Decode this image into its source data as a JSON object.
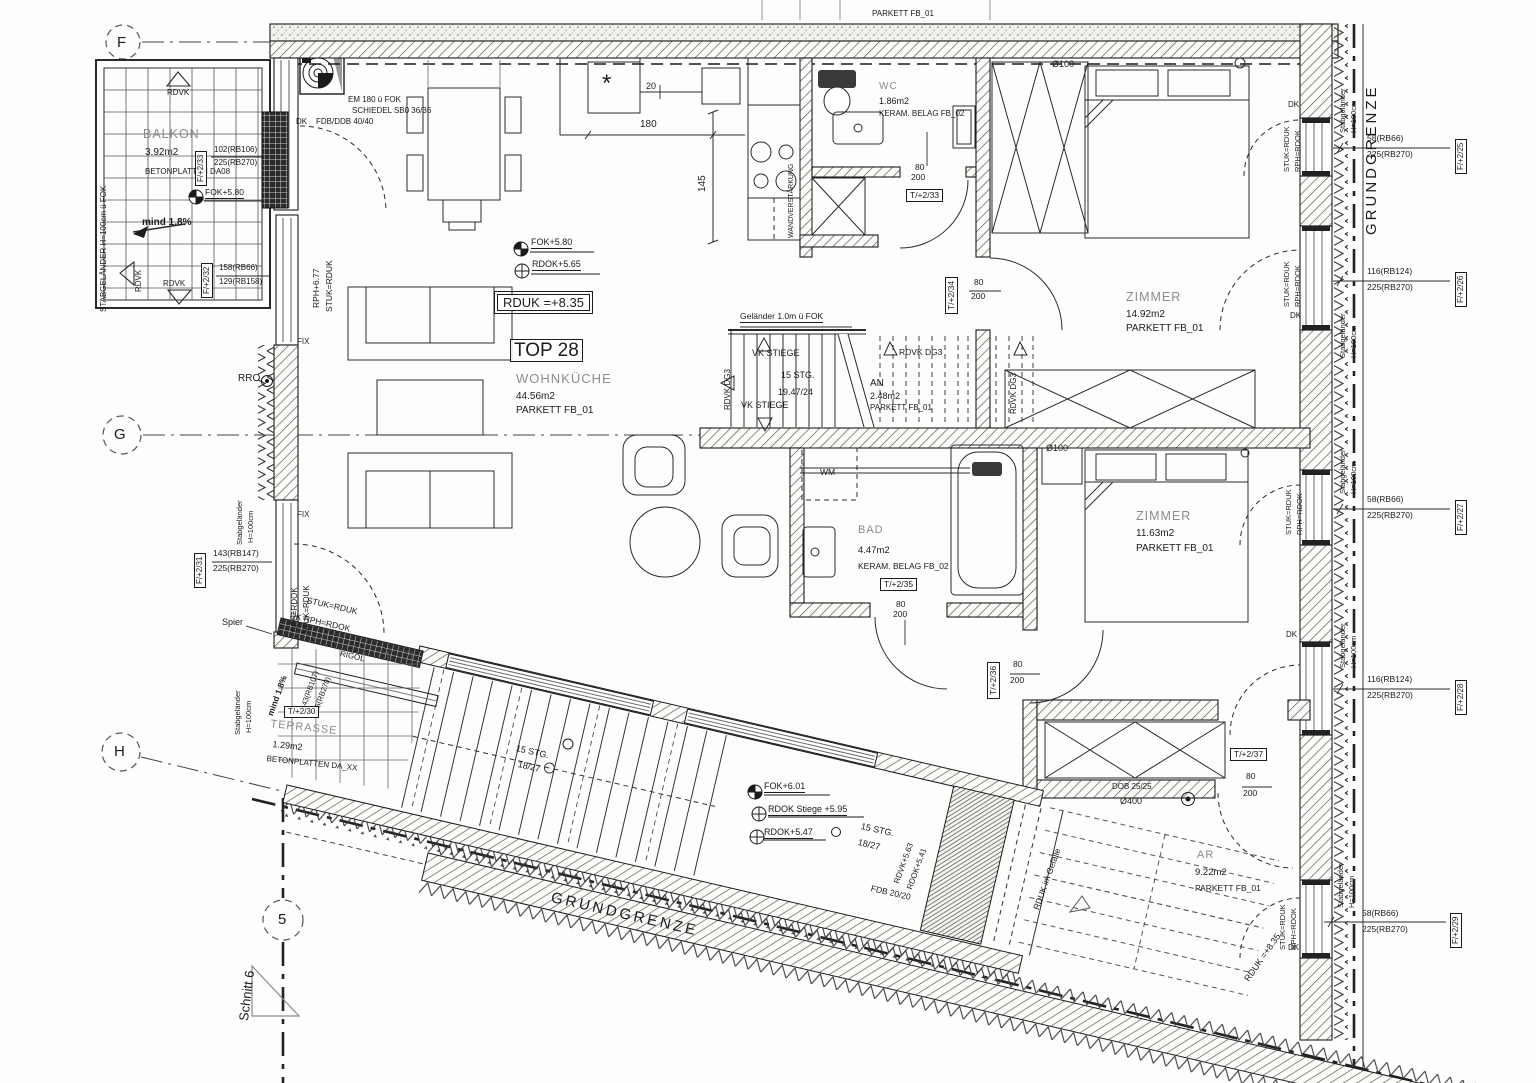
{
  "unit": {
    "tag": "TOP 28",
    "level_box": "RDUK =+8.35"
  },
  "rooms": {
    "wohnkueche": {
      "name": "WOHNKÜCHE",
      "area": "44.56m2",
      "floor": "PARKETT FB_01"
    },
    "balkon": {
      "name": "BALKON",
      "area": "3.92m2",
      "finish": "BETONPLATTEN DA08"
    },
    "terrasse": {
      "name": "TERRASSE",
      "area": "1.29m2",
      "finish": "BETONPLATTEN DA_XX"
    },
    "wc": {
      "name": "WC",
      "area": "1.86m2",
      "finish": "KERAM. BELAG FB_02"
    },
    "bad": {
      "name": "BAD",
      "area": "4.47m2",
      "finish": "KERAM. BELAG FB_02"
    },
    "an": {
      "name": "AN",
      "area": "2.48m2",
      "floor": "PARKETT FB_01"
    },
    "zimmer1": {
      "name": "ZIMMER",
      "area": "14.92m2",
      "floor": "PARKETT FB_01"
    },
    "zimmer2": {
      "name": "ZIMMER",
      "area": "11.63m2",
      "floor": "PARKETT FB_01"
    },
    "ar": {
      "name": "AR",
      "area": "9.22m2",
      "floor": "PARKETT FB_01"
    }
  },
  "levels": {
    "fok580": "FOK+5.80",
    "rdok565": "RDOK+5.65",
    "rph677": "RPH+6.77",
    "fok601": "FOK+6.01",
    "rdok_stiege": "RDOK Stiege +5.95",
    "rdok547": "RDOK+5.47",
    "rdvk563": "RDVK+5.63",
    "rdok541": "RDOK+5.41",
    "rduk835": "RDUK =+8.35",
    "rduk_gefaelle": "RDUK im Gefälle"
  },
  "stairs": {
    "gelaender": "Geländer 1.0m ü FOK",
    "vk_stiege": "VK STIEGE",
    "stg": "15 STG.",
    "steigung_upper": "19.47/24",
    "steigung_lower": "18/27",
    "rdvk_dg3": "RDVK DG3",
    "fdb": "FDB 20/20"
  },
  "grid": {
    "f": "F",
    "g": "G",
    "h": "H",
    "axis5": "5",
    "schnitt": "Schnitt 6"
  },
  "boundary": {
    "grundgrenze": "GRUNDGRENZE"
  },
  "dims": {
    "d20": "20",
    "d180": "180",
    "d145": "145",
    "d80": "80",
    "d200": "200",
    "d100": "Ø100",
    "d400": "Ø400",
    "dob": "DOB 25/25",
    "fdb_ddb": "FDB/DDB 40/40",
    "em": "EM 180 ü FOK",
    "schiedel": "SCHIEDEL SB0 36/36"
  },
  "annotations": {
    "dk": "DK",
    "fix": "FIX",
    "rro": "RRO",
    "wm": "WM",
    "spier": "Spier",
    "rigol": "RIGOL",
    "mind": "mind 1.8%",
    "stuk_rduk": "STUK=RDUK",
    "rph_rdok": "RPH=RDOK",
    "dk_rph_rdok": "DK RPH=RDOK",
    "rdvk": "RDVK",
    "stab": "Stabgeländer",
    "h100": "H=100cm",
    "stab_fok": "STABGELÄNDER H=100cm ü FOK",
    "wandverstaerkung": "WANDVERSTÄRKUNG",
    "parkett_cut": "PARKETT FB_01",
    "star": "*"
  },
  "openings": {
    "windows": [
      {
        "tag": "F/+2/25",
        "c1": "58(RB66)",
        "c2": "225(RB270)"
      },
      {
        "tag": "F/+2/26",
        "c1": "116(RB124)",
        "c2": "225(RB270)"
      },
      {
        "tag": "F/+2/27",
        "c1": "58(RB66)",
        "c2": "225(RB270)"
      },
      {
        "tag": "F/+2/28",
        "c1": "116(RB124)",
        "c2": "225(RB270)"
      },
      {
        "tag": "F/+2/29",
        "c1": "58(RB66)",
        "c2": "225(RB270)"
      },
      {
        "tag": "F/+2/31",
        "c1": "143(RB147)",
        "c2": "225(RB270)"
      },
      {
        "tag": "F/+2/32",
        "c1": "158(RB66)",
        "c2": "129(RB158)"
      },
      {
        "tag": "F/+2/33",
        "c1": "102(RB106)",
        "c2": "225(RB270)"
      }
    ],
    "doors": [
      {
        "tag": "T/+2/30"
      },
      {
        "tag": "T/+2/33"
      },
      {
        "tag": "T/+2/34"
      },
      {
        "tag": "T/+2/35"
      },
      {
        "tag": "T/+2/36"
      },
      {
        "tag": "T/+2/37"
      }
    ],
    "terrasse_codes": {
      "c1": "143(RB107)",
      "c2": "225(RB270)"
    }
  }
}
